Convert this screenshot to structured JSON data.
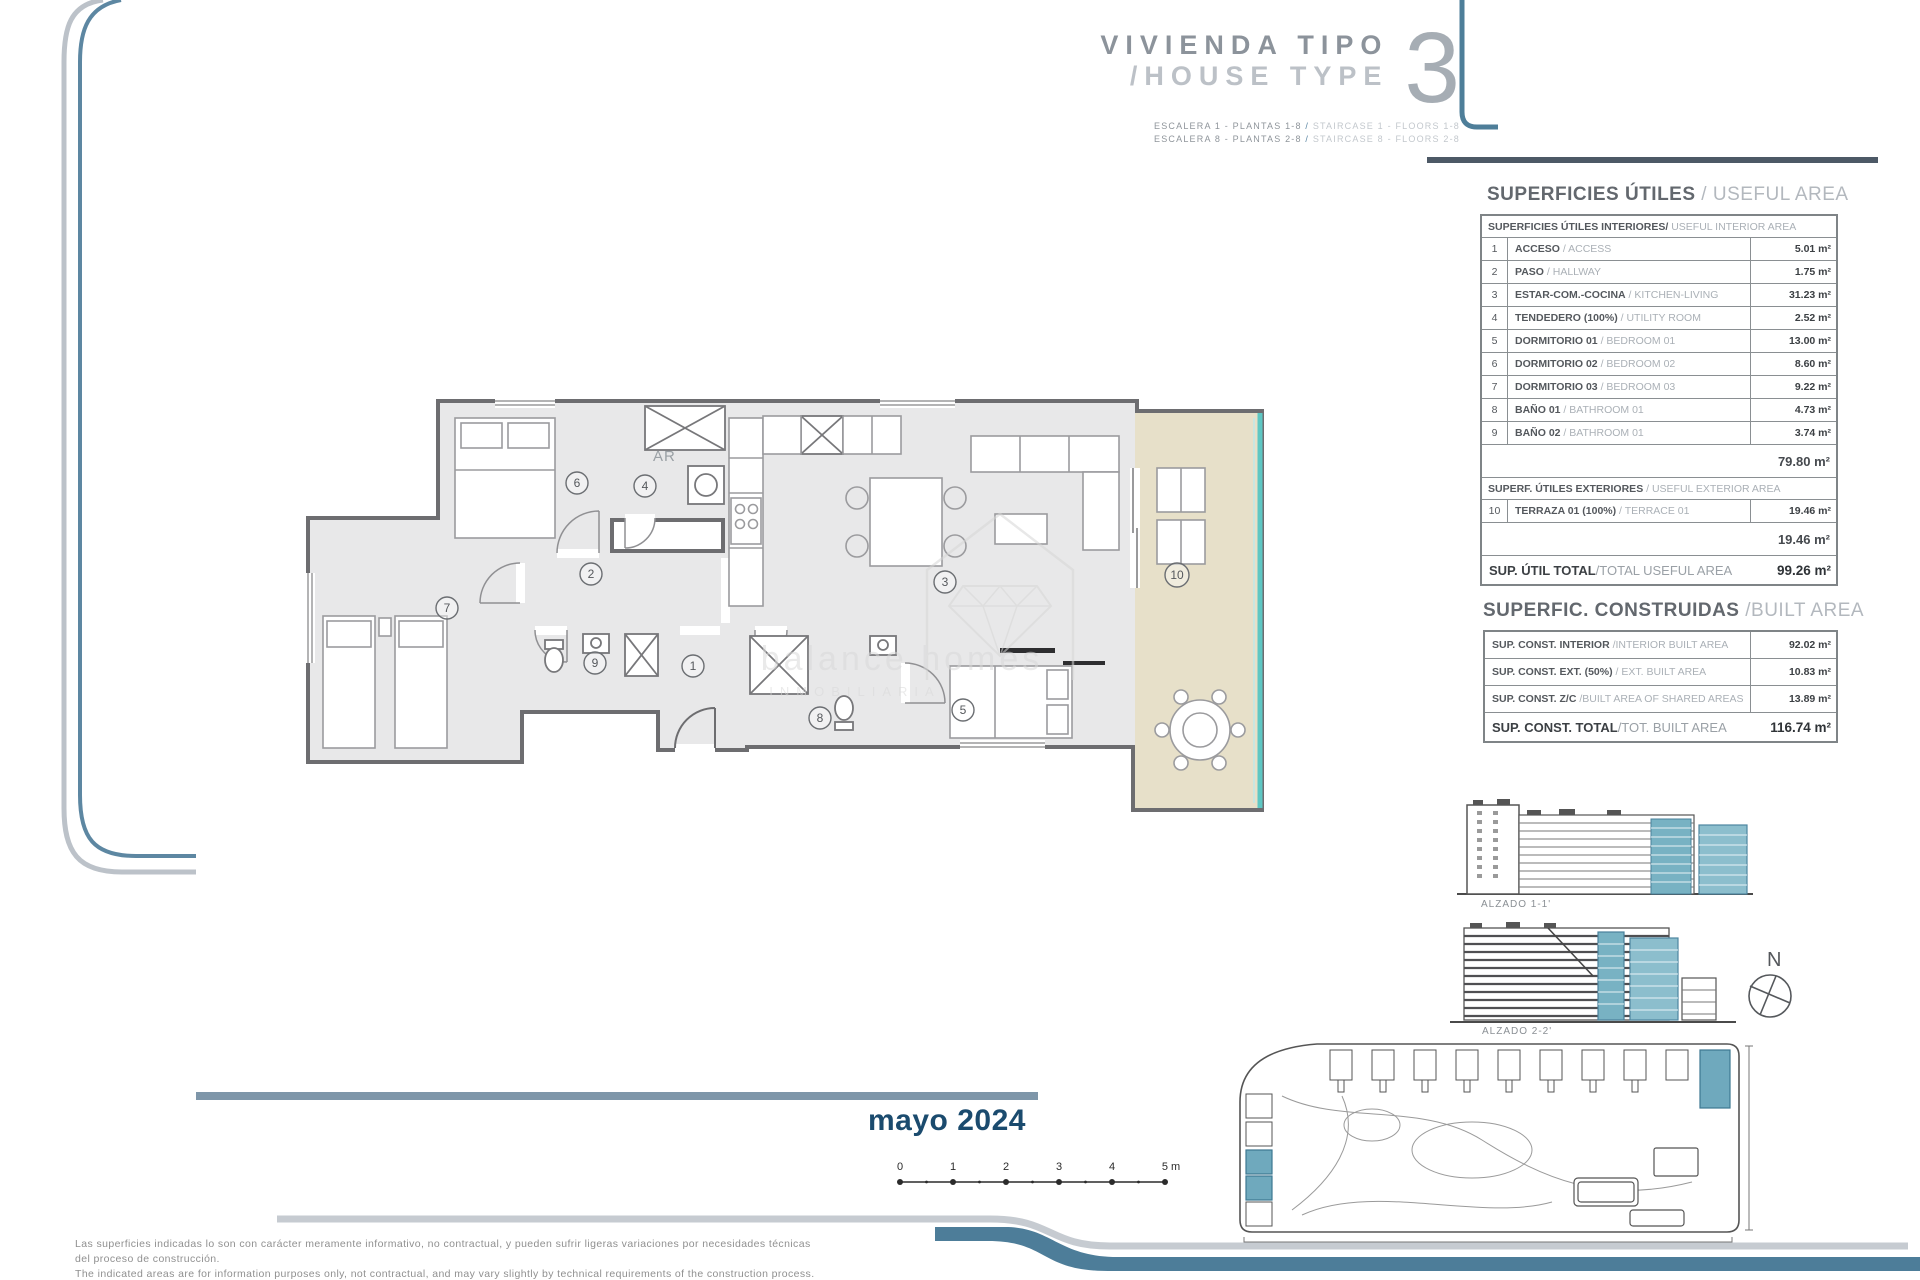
{
  "title": {
    "line1": "VIVIENDA TIPO",
    "line2": "/HOUSE TYPE",
    "number": "3",
    "sub1_es": "ESCALERA 1 - PLANTAS 1-8",
    "sub1_en": "STAIRCASE 1 - FLOORS 1-8",
    "sub2_es": "ESCALERA 8 - PLANTAS 2-8",
    "sub2_en": "STAIRCASE 8 - FLOORS 2-8",
    "slash": " / "
  },
  "useful_area": {
    "title_es": "SUPERFICIES ÚTILES",
    "title_en": " / USEFUL AREA",
    "interior_header_es": "SUPERFICIES ÚTILES INTERIORES/",
    "interior_header_en": " USEFUL INTERIOR AREA",
    "sep": " / ",
    "rows": [
      {
        "num": "1",
        "es": "ACCESO",
        "en": "ACCESS",
        "value": "5.01 m²"
      },
      {
        "num": "2",
        "es": "PASO",
        "en": "HALLWAY",
        "value": "1.75 m²"
      },
      {
        "num": "3",
        "es": "ESTAR-COM.-COCINA",
        "en": "KITCHEN-LIVING",
        "value": "31.23 m²"
      },
      {
        "num": "4",
        "es": "TENDEDERO (100%)",
        "en": "UTILITY ROOM",
        "value": "2.52 m²"
      },
      {
        "num": "5",
        "es": "DORMITORIO 01",
        "en": "BEDROOM 01",
        "value": "13.00 m²"
      },
      {
        "num": "6",
        "es": "DORMITORIO 02",
        "en": "BEDROOM 02",
        "value": "8.60 m²"
      },
      {
        "num": "7",
        "es": "DORMITORIO 03",
        "en": "BEDROOM 03",
        "value": "9.22 m²"
      },
      {
        "num": "8",
        "es": "BAÑO 01",
        "en": "BATHROOM 01",
        "value": "4.73 m²"
      },
      {
        "num": "9",
        "es": "BAÑO 02",
        "en": "BATHROOM 01",
        "value": "3.74 m²"
      }
    ],
    "interior_subtotal": "79.80 m²",
    "exterior_header_es": "SUPERF. ÚTILES EXTERIORES",
    "exterior_header_en": " / USEFUL EXTERIOR AREA",
    "exterior_row": {
      "num": "10",
      "es": "TERRAZA 01 (100%)",
      "en": "TERRACE 01",
      "value": "19.46 m²"
    },
    "exterior_subtotal": "19.46 m²",
    "total_es": "SUP. ÚTIL TOTAL",
    "total_en": "/TOTAL USEFUL AREA",
    "total_value": "99.26 m²"
  },
  "built_area": {
    "title_es": "SUPERFIC. CONSTRUIDAS",
    "title_en": " /BUILT AREA",
    "rows": [
      {
        "es": "SUP. CONST. INTERIOR",
        "en": "/INTERIOR BUILT AREA",
        "value": "92.02 m²"
      },
      {
        "es": "SUP. CONST. EXT. (50%)",
        "en": "/ EXT. BUILT AREA",
        "value": "10.83 m²"
      },
      {
        "es": "SUP. CONST. Z/C",
        "en": "/BUILT AREA OF SHARED AREAS",
        "value": "13.89 m²"
      }
    ],
    "total_es": "SUP. CONST. TOTAL",
    "total_en": "/TOT. BUILT AREA",
    "total_value": "116.74 m²"
  },
  "plan": {
    "rooms": [
      "1",
      "2",
      "3",
      "4",
      "5",
      "6",
      "7",
      "8",
      "9",
      "10"
    ],
    "ar_label": "AR",
    "watermark_line1": "balance homes",
    "watermark_line2": "INMOBILIARIA"
  },
  "elevations": {
    "label1": "ALZADO 1-1'",
    "label2": "ALZADO 2-2'"
  },
  "compass": {
    "label": "N"
  },
  "date": "mayo 2024",
  "scalebar": {
    "ticks": [
      "0",
      "1",
      "2",
      "3",
      "4",
      "5 m"
    ]
  },
  "disclaimer": {
    "es1": "Las superficies indicadas lo son con carácter meramente informativo, no contractual, y pueden sufrir ligeras variaciones por necesidades técnicas",
    "es2": "del proceso de construcción.",
    "en": "The indicated areas are for information purposes only, not contractual, and may vary slightly by technical requirements of the construction process."
  },
  "colors": {
    "glass_teal": "#5ec7c3",
    "terrace_beige": "#e7e0c9",
    "wall_gray": "#6d6d70",
    "floor_gray": "#e8e8e9",
    "accent_slate": "#4d7d99",
    "elevation_teal": "#78b2c3",
    "date_blue": "#1b4b6e"
  }
}
